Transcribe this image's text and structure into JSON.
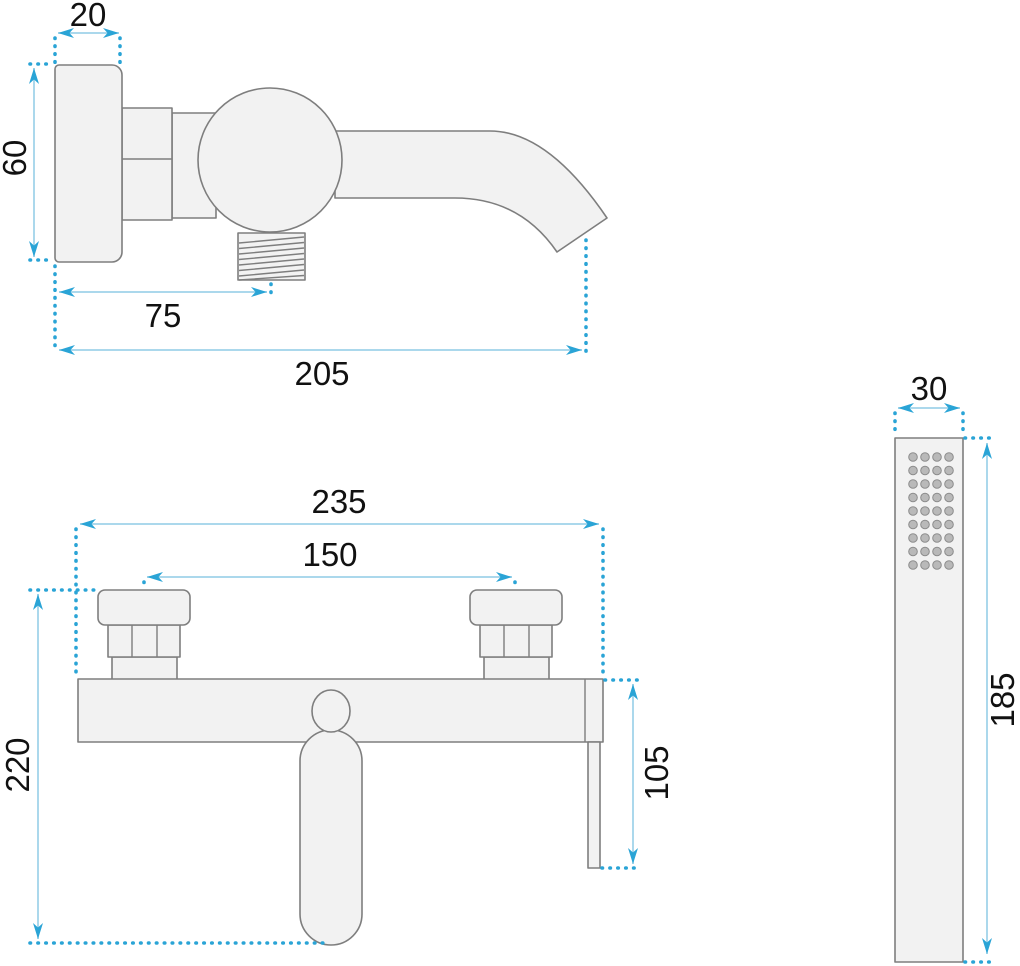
{
  "drawing": {
    "type": "technical dimension drawing",
    "subject": "wall-mounted bath mixer tap with hand shower",
    "views": {
      "side_view": {
        "name": "mixer side view",
        "dims": {
          "plate_width": "20",
          "plate_height": "60",
          "outlet_offset": "75",
          "spout_reach": "205"
        }
      },
      "front_view": {
        "name": "mixer front view",
        "dims": {
          "total_width": "235",
          "connection_spacing": "150",
          "total_height": "220",
          "lever_drop": "105"
        }
      },
      "hand_shower": {
        "name": "hand shower view",
        "dims": {
          "width": "30",
          "length": "185"
        }
      }
    },
    "colors": {
      "dimension_line": "#8fcbe5",
      "dimension_accent": "#2aa4d6",
      "part_fill": "#f2f2f2",
      "part_stroke": "#7e7e7e",
      "label_text": "#111111",
      "nozzle_fill": "#b9b9b9",
      "background": "#ffffff"
    }
  }
}
